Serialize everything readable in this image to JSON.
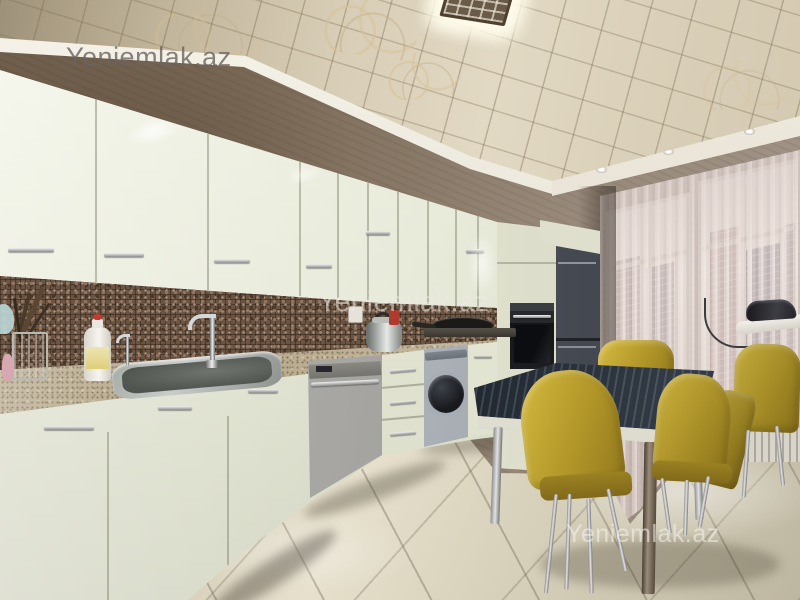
{
  "scene": {
    "description": "kitchen-interior-listing-photo",
    "objects": [
      "decorative-ceiling-light-panel",
      "upper-cabinets",
      "mosaic-backsplash",
      "granite-countertop",
      "sink",
      "faucet",
      "dish-soap-bottle",
      "utensil-holder",
      "electric-kettle",
      "frying-pan",
      "cooktop",
      "dishwasher",
      "drawer-unit",
      "washing-machine",
      "tall-cabinet",
      "built-in-oven",
      "refrigerator",
      "window-left",
      "window-right",
      "sheer-curtains",
      "city-buildings-view",
      "dining-table",
      "yellow-chairs",
      "ironing-board",
      "clothes-iron",
      "radiator",
      "marble-floor"
    ]
  },
  "watermarks": {
    "top_left": "Yeniemlak.az",
    "center": "Yeniemlak.az",
    "bottom_right": "Yeniemlak.az"
  },
  "palette": {
    "ceiling_champagne": "#d8cdb6",
    "cornice_white": "#f6f3ea",
    "wall_taupe": "#8d7d6c",
    "backsplash_brown": "#6a5544",
    "counter_beige": "#b5a688",
    "cabinet_cream": "#eaecdc",
    "dishwasher_steel": "#a7a6a2",
    "washer_silver": "#aab0b6",
    "fridge_graphite": "#3a3e45",
    "oven_black": "#1b1d21",
    "chair_mustard": "#b29729",
    "curtain_blush": "#e4d8d4",
    "floor_cream": "#d8d2bd",
    "table_glass_dark": "#2b343d",
    "table_print_orange": "#c97b2e"
  }
}
